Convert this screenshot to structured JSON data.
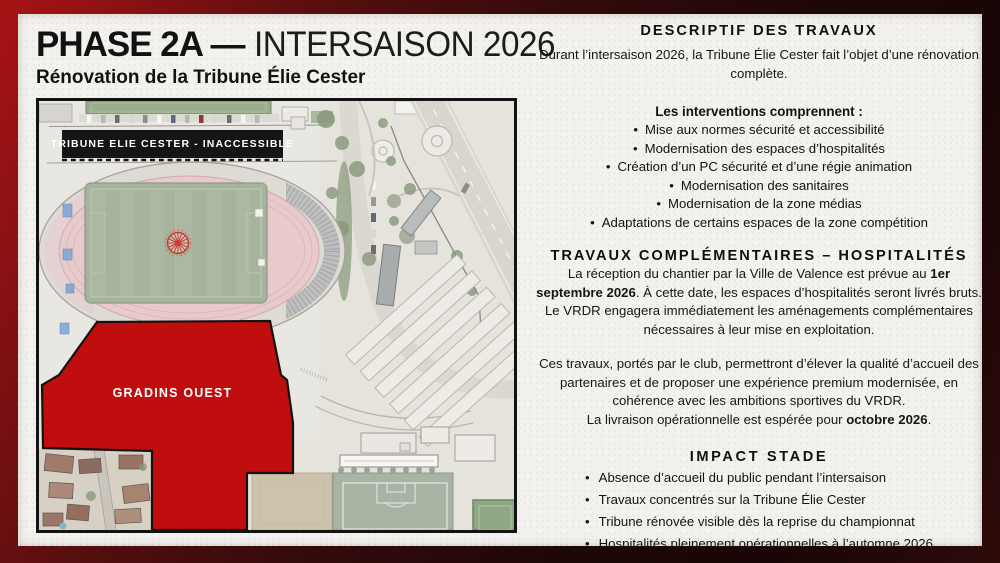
{
  "slide": {
    "title_bold": "PHASE 2A —",
    "title_light": "INTERSAISON 2026",
    "subtitle": "Rénovation de la Tribune Élie Cester"
  },
  "map": {
    "tribune_label": "TRIBUNE ELIE CESTER - INACCESSIBLE",
    "gradins_label": "GRADINS OUEST"
  },
  "sections": {
    "descriptif": {
      "heading": "DESCRIPTIF DES TRAVAUX",
      "intro": "Durant l’intersaison 2026, la Tribune Élie Cester fait l’objet d’une rénovation complète.",
      "interventions_heading": "Les interventions comprennent :",
      "interventions": [
        "Mise aux normes sécurité et accessibilité",
        "Modernisation des espaces d’hospitalités",
        "Création d’un PC sécurité et d’une régie animation",
        "Modernisation des sanitaires",
        "Modernisation de la zone médias",
        "Adaptations de certains espaces de la zone compétition"
      ]
    },
    "travaux": {
      "heading": "TRAVAUX COMPLÉMENTAIRES – HOSPITALITÉS",
      "p1_before": "La réception du chantier par la Ville de Valence est prévue au ",
      "p1_bold": "1er septembre 2026",
      "p1_after": ". À cette date, les espaces d’hospitalités seront livrés bruts. Le VRDR engagera immédiatement les aménagements complémentaires nécessaires à leur mise en exploitation.",
      "p2": "Ces travaux, portés par le club, permettront d’élever la qualité d’accueil des partenaires et de proposer une expérience premium modernisée, en cohérence avec les ambitions sportives du VRDR.",
      "p3_before": "La livraison opérationnelle est espérée pour ",
      "p3_bold": "octobre 2026",
      "p3_after": "."
    },
    "impact": {
      "heading": "IMPACT STADE",
      "items": [
        "Absence d’accueil du public pendant l’intersaison",
        "Travaux concentrés sur la Tribune Élie Cester",
        "Tribune rénovée visible dès la reprise du championnat",
        "Hospitalités pleinement opérationnelles à l’automne 2026"
      ]
    }
  },
  "colors": {
    "zone_red": "#c00d0e",
    "frame_red": "#a81314",
    "label_black": "#151515",
    "paper": "#f3f2ee"
  }
}
